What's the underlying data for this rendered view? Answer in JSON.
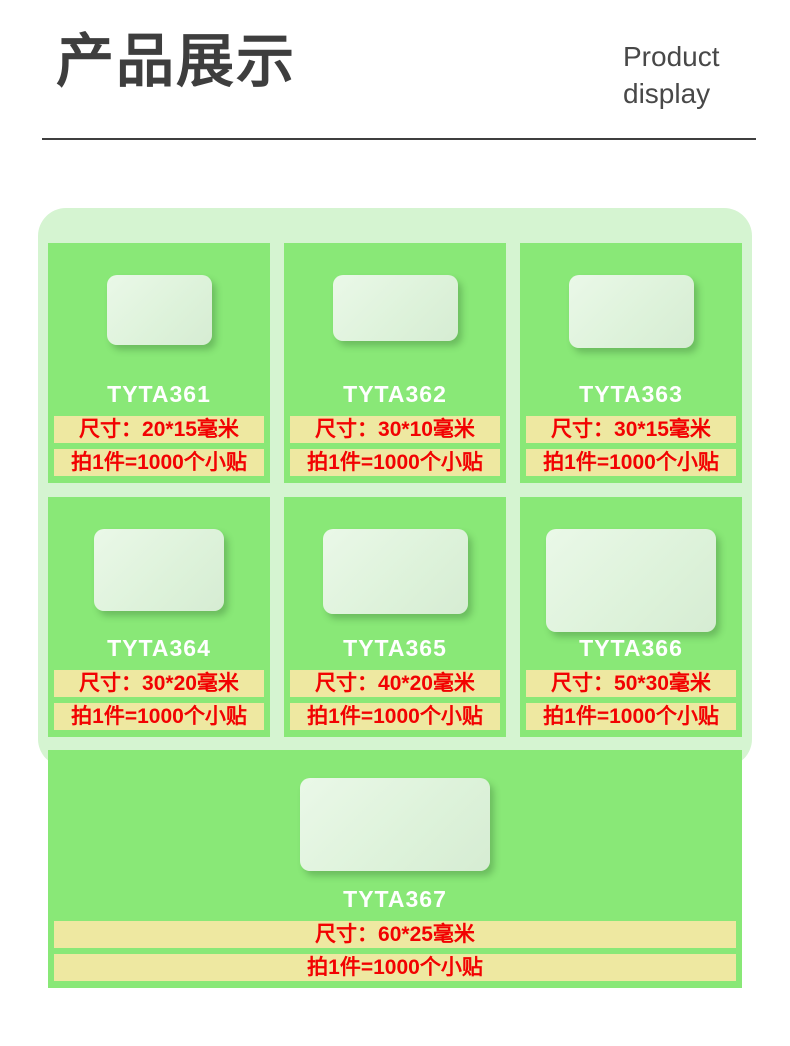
{
  "header": {
    "title": "产品展示",
    "subtitle": "Product\ndisplay"
  },
  "panel": {
    "products": [
      {
        "code": "TYTA361",
        "size": "尺寸：20*15毫米",
        "qty": "拍1件=1000个小贴"
      },
      {
        "code": "TYTA362",
        "size": "尺寸：30*10毫米",
        "qty": "拍1件=1000个小贴"
      },
      {
        "code": "TYTA363",
        "size": "尺寸：30*15毫米",
        "qty": "拍1件=1000个小贴"
      },
      {
        "code": "TYTA364",
        "size": "尺寸：30*20毫米",
        "qty": "拍1件=1000个小贴"
      },
      {
        "code": "TYTA365",
        "size": "尺寸：40*20毫米",
        "qty": "拍1件=1000个小贴"
      },
      {
        "code": "TYTA366",
        "size": "尺寸：50*30毫米",
        "qty": "拍1件=1000个小贴"
      },
      {
        "code": "TYTA367",
        "size": "尺寸：60*25毫米",
        "qty": "拍1件=1000个小贴"
      }
    ]
  },
  "colors": {
    "panel_bg": "#d5f4d1",
    "card_bg": "#89e877",
    "strip_bg": "#eee8a1",
    "strip_text": "#f20202",
    "code_text": "#ffffff",
    "title_text": "#3e3e3e",
    "subtitle_text": "#484848",
    "rule_color": "#3f3f3f"
  }
}
